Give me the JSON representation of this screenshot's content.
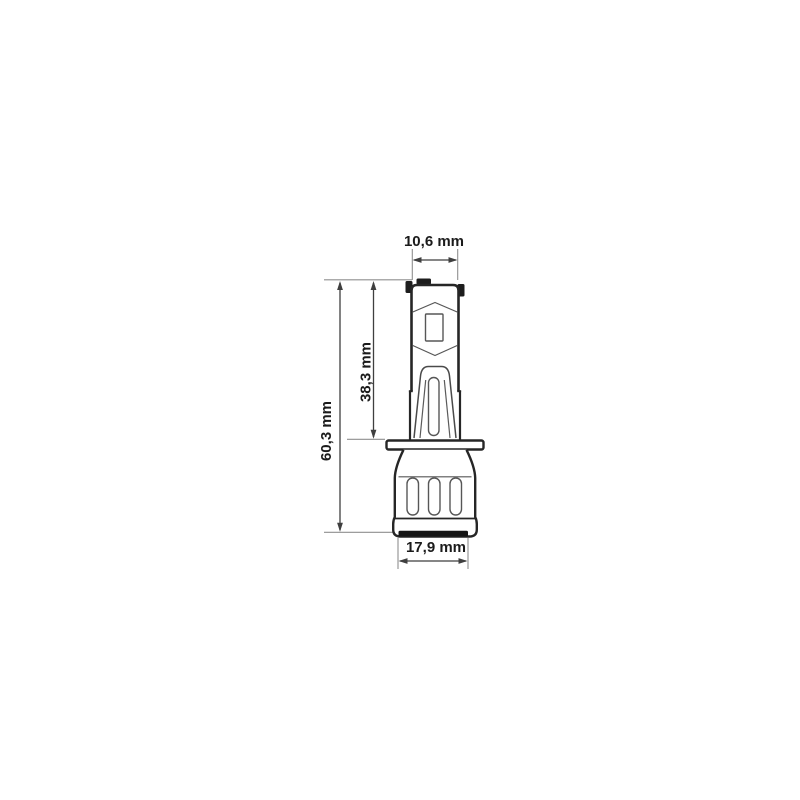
{
  "diagram": {
    "type": "technical-dimension-drawing",
    "subject": "H1 LED bulb side view with dimension callouts",
    "units": "mm",
    "dimensions": {
      "top_width": "10,6 mm",
      "body_height": "38,3 mm",
      "total_height": "60,3 mm",
      "base_width": "17,9 mm"
    },
    "colors": {
      "background": "#ffffff",
      "outline_thick": "#262626",
      "outline_thin": "#575757",
      "dimension_line": "#3f3f3f",
      "extension_line": "#8f8f8f",
      "text": "#1b1b1b"
    }
  }
}
